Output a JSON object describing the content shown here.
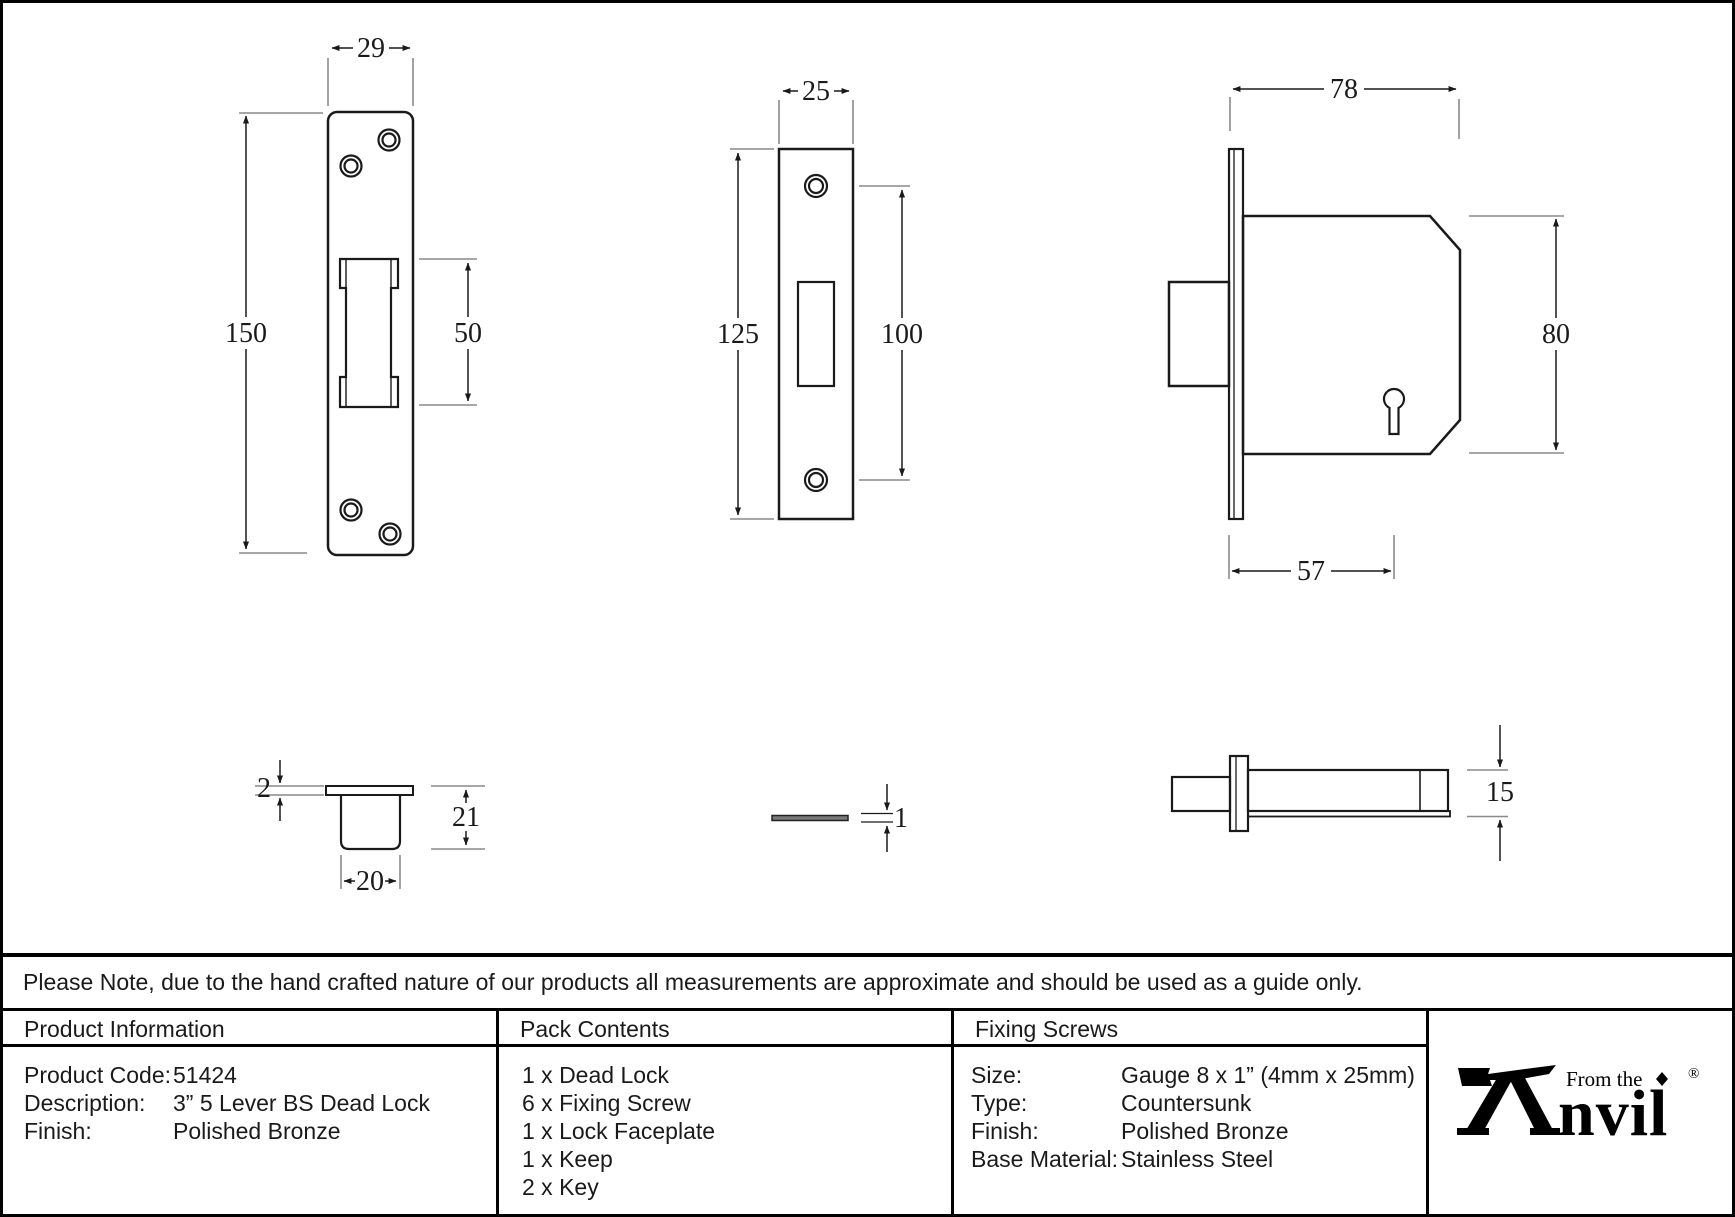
{
  "note": {
    "text": "Please Note, due to the hand crafted nature of our products all measurements are approximate and should be used as a guide only."
  },
  "drawings": {
    "keep_front": {
      "width": "29",
      "height": "150",
      "slot_height": "50"
    },
    "faceplate_front": {
      "width": "25",
      "height": "125",
      "hole_spacing": "100"
    },
    "lock_front": {
      "width": "78",
      "height": "80",
      "backset": "57"
    },
    "keep_side": {
      "plate_thickness": "2",
      "depth": "21",
      "width": "20"
    },
    "faceplate_side": {
      "thickness": "1"
    },
    "lock_side": {
      "thickness": "15"
    }
  },
  "table": {
    "product_information": {
      "header": "Product Information",
      "rows": [
        {
          "label": "Product Code:",
          "value": "51424"
        },
        {
          "label": "Description:",
          "value": "3” 5 Lever BS Dead Lock"
        },
        {
          "label": "Finish:",
          "value": "Polished Bronze"
        }
      ]
    },
    "pack_contents": {
      "header": "Pack Contents",
      "items": [
        "1 x Dead Lock",
        "6 x Fixing Screw",
        "1 x Lock Faceplate",
        "1 x Keep",
        "2 x Key"
      ]
    },
    "fixing_screws": {
      "header": "Fixing Screws",
      "rows": [
        {
          "label": "Size:",
          "value": "Gauge 8 x 1” (4mm x 25mm)"
        },
        {
          "label": "Type:",
          "value": "Countersunk"
        },
        {
          "label": "Finish:",
          "value": "Polished Bronze"
        },
        {
          "label": "Base Material:",
          "value": "Stainless Steel"
        }
      ]
    }
  },
  "logo": {
    "prefix": "From the",
    "brand_suffix": "nvil",
    "registered": "®"
  },
  "colors": {
    "object_line": "#1a1a1a",
    "extension_line": "#8a8a8a",
    "border": "#000000",
    "background": "#ffffff"
  }
}
